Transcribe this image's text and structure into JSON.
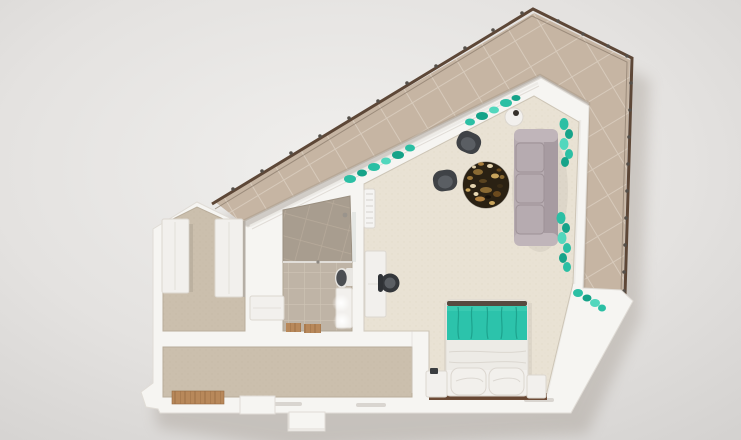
{
  "scene": {
    "kind": "apartment-top-down-3d-render",
    "colors": {
      "background_inner": "#f0efed",
      "background_outer": "#d2d0ce",
      "shadow": "#8f8478",
      "slab_white": "#f6f5f2",
      "wall_edge": "#e0dcd6",
      "balcony_tile": "#c6b5a3",
      "balcony_grout": "#d7cabb",
      "balcony_inner_shade": "#9c8d7c",
      "railing_brown": "#5d4737",
      "railing_post": "#55504a",
      "railing_rail2": "#8a7a6b",
      "living_floor": "#e9e2d4",
      "living_floor_dot": "#ddd4c3",
      "hall_floor": "#cbbfad",
      "hall_floor_dot": "#bfb29f",
      "bath_floor": "#bfb4a6",
      "bath_grout": "#cfc4b5",
      "shower_tile": "#a89d8f",
      "shower_grout": "#b8ab9b",
      "wood": "#b8885a",
      "wood_dark": "#966a41",
      "ledge_brown": "#6d4b36",
      "sofa": "#b6abb0",
      "sofa_back": "#a79ba1",
      "sofa_arm": "#c0b5ba",
      "cushion_line": "#9d9196",
      "rug_base": "#2a2113",
      "rug_gold": "#c9a55d",
      "rug_brown": "#8a6a33",
      "rug_cream": "#e4d3ae",
      "rug_dark": "#17110a",
      "chair_dark": "#3f4246",
      "chair_seat": "#5a5e63",
      "desk_chair": "#34373b",
      "plant_teal": "#2bbfa4",
      "plant_dark": "#16a389",
      "plant_light": "#52d7bd",
      "bed_teal": "#2cc3ab",
      "bed_teal_fold": "#1da38e",
      "bed_trim": "#564a40",
      "duvet": "#edebe6",
      "duvet_fold": "#dbd7d0",
      "pillow": "#f2f0ec",
      "furniture_white": "#f2f0ed",
      "furniture_stroke": "#dcd7d0",
      "toilet_lid": "#4b4e52",
      "toilet_base": "#e8e6e2",
      "ac_white": "#f5f4f2",
      "ac_line": "#d5d2ce",
      "glass": "#eceae6",
      "glass_shade": "#cfc9c0",
      "mirror": "#d7dbd8",
      "slot": "#d9d5d0",
      "glow": "#ffffff"
    },
    "regions": [
      "balcony-terrace",
      "living-room",
      "bedroom",
      "bathroom",
      "hallway",
      "entry-corridor"
    ],
    "furniture": [
      "sofa",
      "round-rug",
      "armchair",
      "side-table",
      "bed",
      "nightstand",
      "desk",
      "desk-chair",
      "wardrobe",
      "vanity",
      "toilet",
      "shower",
      "washer-counter",
      "ac-unit",
      "window-plants"
    ]
  }
}
